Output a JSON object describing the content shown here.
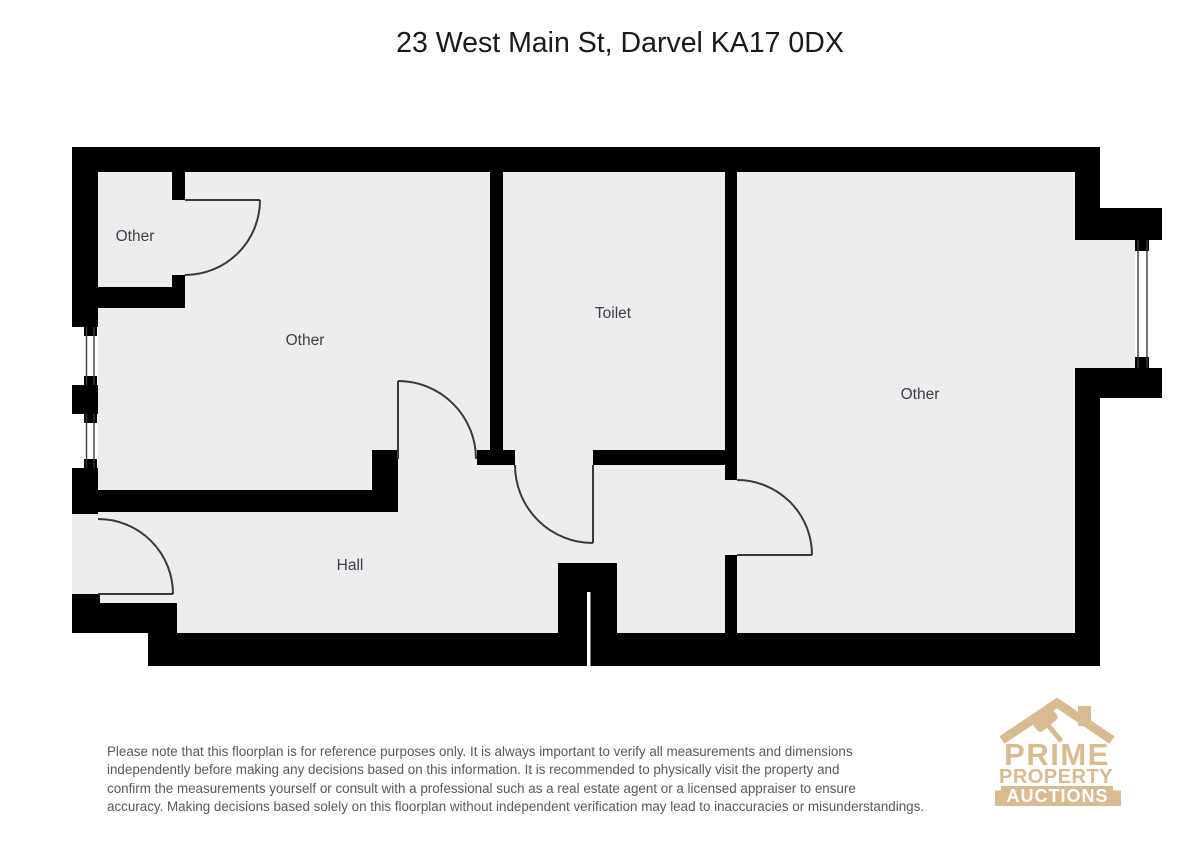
{
  "title": "23 West Main St, Darvel KA17 0DX",
  "floorplan": {
    "rooms": [
      {
        "name": "small-room-top-left",
        "label": "Other"
      },
      {
        "name": "left-room",
        "label": "Other"
      },
      {
        "name": "toilet",
        "label": "Toilet"
      },
      {
        "name": "right-room",
        "label": "Other"
      },
      {
        "name": "hall",
        "label": "Hall"
      }
    ]
  },
  "disclaimer": {
    "lines": [
      "Please note that this floorplan is for reference purposes only. It is always important to verify all measurements and dimensions",
      "independently before making any decisions based on this information. It is recommended to physically visit the property and",
      "confirm the measurements yourself or consult with a professional such as a real estate agent or a licensed appraiser to ensure",
      "accuracy. Making decisions based solely on this floorplan without independent verification may lead to inaccuracies or misunderstandings."
    ]
  },
  "logo": {
    "brand_line1": "PRIME",
    "brand_line2": "PROPERTY",
    "brand_line3": "AUCTIONS"
  },
  "colors": {
    "wall": "#000000",
    "floor": "#ededef",
    "door_line": "#3a3a3a",
    "room_label": "#3c4043",
    "disclaimer_text": "#58595b",
    "logo_tan": "#d9bb92",
    "logo_banner_text": "#ffffff"
  }
}
